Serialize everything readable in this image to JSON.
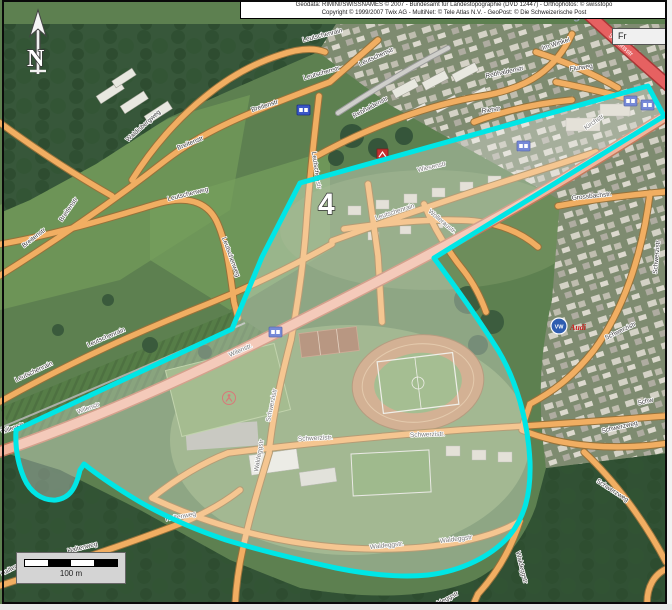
{
  "map": {
    "attribution": {
      "line1": "Geodata: RIMINI/SWISSNAMES © 2007 - Bundesamt für Landestopographie (DVD 12447) - Orthophotos: © swisstopo",
      "line2": "Copyright © 1999/2007 Twix AG - MultiNet: © Tele Atlas N.V. - GeoPost: © Die Schweizerische Post"
    },
    "watermark": "DigitalZoom",
    "partial_button": "Fr",
    "north_label": "N",
    "scale_label": "100 m",
    "area_label": "4",
    "brands": {
      "vw": "VW",
      "audi": "Audi"
    },
    "colors": {
      "highlight_outline": "#00e6e6",
      "highlight_fill": "rgba(255,255,255,0.30)",
      "minor_road": "#f1ae62",
      "major_road": "#f0b49c",
      "red_road": "#e66161",
      "forest": "#2c4c2e",
      "field": "#5d8050"
    },
    "route_shields": [
      {
        "x": 297,
        "y": 105
      },
      {
        "x": 517,
        "y": 141
      },
      {
        "x": 269,
        "y": 327
      },
      {
        "x": 624,
        "y": 96
      },
      {
        "x": 641,
        "y": 100
      }
    ],
    "streets": [
      {
        "text": "Breitenstr",
        "x": 24,
        "y": 248,
        "r": -38
      },
      {
        "text": "Breitenstr",
        "x": 62,
        "y": 222,
        "r": -55
      },
      {
        "text": "Breitenstr",
        "x": 178,
        "y": 150,
        "r": -22
      },
      {
        "text": "Breitenstr",
        "x": 252,
        "y": 112,
        "r": -18
      },
      {
        "text": "Waldisbergweg",
        "x": 128,
        "y": 142,
        "r": -42
      },
      {
        "text": "Leutschenweg",
        "x": 168,
        "y": 201,
        "r": -14
      },
      {
        "text": "Leutschenweg",
        "x": 222,
        "y": 238,
        "r": 70
      },
      {
        "text": "Leutschenrain",
        "x": 16,
        "y": 382,
        "r": -25
      },
      {
        "text": "Leutschenrain",
        "x": 88,
        "y": 347,
        "r": -23
      },
      {
        "text": "Leutschenrain",
        "x": 303,
        "y": 42,
        "r": -14
      },
      {
        "text": "Leutschenstr",
        "x": 304,
        "y": 80,
        "r": -16
      },
      {
        "text": "Leutschenstr",
        "x": 360,
        "y": 66,
        "r": -24
      },
      {
        "text": "Leutschenstr",
        "x": 312,
        "y": 152,
        "r": 82
      },
      {
        "text": "Rebhaldenstr",
        "x": 354,
        "y": 118,
        "r": -28
      },
      {
        "text": "Rebhaldenstr",
        "x": 486,
        "y": 78,
        "r": -12
      },
      {
        "text": "Rietstr",
        "x": 482,
        "y": 113,
        "r": -8
      },
      {
        "text": "Wiesenstr",
        "x": 418,
        "y": 172,
        "r": -13
      },
      {
        "text": "Leutschenrain",
        "x": 376,
        "y": 220,
        "r": -18
      },
      {
        "text": "Wolleraustr.",
        "x": 428,
        "y": 212,
        "r": 40
      },
      {
        "text": "Kirchstr",
        "x": 586,
        "y": 130,
        "r": -35
      },
      {
        "text": "Grossbachstr.",
        "x": 572,
        "y": 200,
        "r": -6
      },
      {
        "text": "Im Winkel",
        "x": 543,
        "y": 50,
        "r": -18
      },
      {
        "text": "Flurweg",
        "x": 570,
        "y": 71,
        "r": -8
      },
      {
        "text": "Stationsstr",
        "x": 608,
        "y": 36,
        "r": 42,
        "color": "#ffffff"
      },
      {
        "text": "Wilenstr.",
        "x": 230,
        "y": 357,
        "r": -24
      },
      {
        "text": "Wilenstr",
        "x": 78,
        "y": 414,
        "r": -20
      },
      {
        "text": "Wilenstr",
        "x": 2,
        "y": 434,
        "r": -20
      },
      {
        "text": "Schwerzistr.",
        "x": 298,
        "y": 441,
        "r": -3
      },
      {
        "text": "Schwerzistr.",
        "x": 410,
        "y": 437,
        "r": -2
      },
      {
        "text": "Schwerzistr",
        "x": 270,
        "y": 422,
        "r": -78
      },
      {
        "text": "Schwerzistr",
        "x": 606,
        "y": 340,
        "r": -26
      },
      {
        "text": "Schwerzistr",
        "x": 657,
        "y": 274,
        "r": -85
      },
      {
        "text": "Schw",
        "x": 638,
        "y": 405,
        "r": -12
      },
      {
        "text": "Schwerzweg",
        "x": 602,
        "y": 433,
        "r": -13
      },
      {
        "text": "Schwerzweg",
        "x": 596,
        "y": 482,
        "r": 33
      },
      {
        "text": "Waldeggstr.",
        "x": 370,
        "y": 549,
        "r": -6
      },
      {
        "text": "Waldeggstr",
        "x": 440,
        "y": 543,
        "r": -7
      },
      {
        "text": "Waldeggstr",
        "x": 258,
        "y": 472,
        "r": -80
      },
      {
        "text": "Waldeggstr",
        "x": 516,
        "y": 552,
        "r": 76
      },
      {
        "text": "Waldeggstr",
        "x": 430,
        "y": 610,
        "r": -28
      },
      {
        "text": "Haltenweg",
        "x": 68,
        "y": 553,
        "r": -14
      },
      {
        "text": "Haltenweg",
        "x": 2,
        "y": 576,
        "r": -28
      },
      {
        "text": "Haltenweg",
        "x": 166,
        "y": 521,
        "r": -10
      }
    ]
  }
}
